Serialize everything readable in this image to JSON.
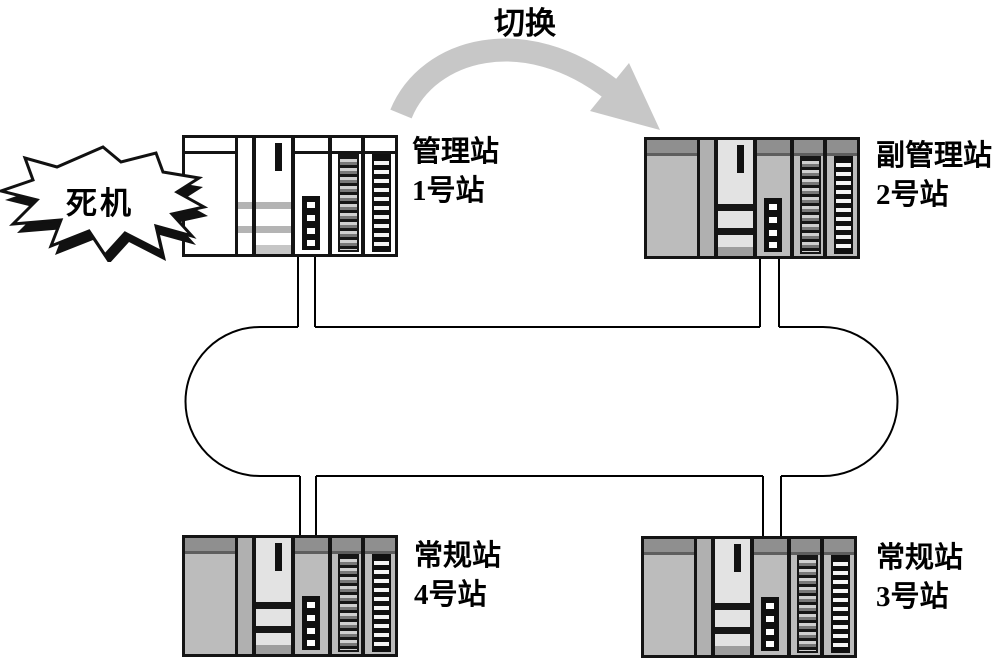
{
  "diagram": {
    "switch_label": "切换",
    "crash_label": "死机"
  },
  "stations": [
    {
      "role": "管理站",
      "number": "1号站",
      "state": "crashed"
    },
    {
      "role": "副管理站",
      "number": "2号站",
      "state": "normal"
    },
    {
      "role": "常规站",
      "number": "3号站",
      "state": "normal"
    },
    {
      "role": "常规站",
      "number": "4号站",
      "state": "normal"
    }
  ],
  "colors": {
    "line": "#000000",
    "arrow": "#c7c7c7",
    "rack_gray_body": "#bcbcbc",
    "rack_gray_header": "#8f8f8f",
    "rack_light_body": "#ffffff",
    "burst_fill": "#ffffff",
    "burst_outline": "#111111"
  }
}
